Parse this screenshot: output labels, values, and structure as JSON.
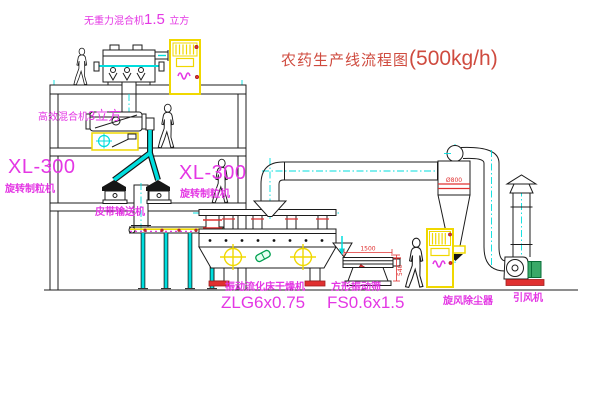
{
  "title": {
    "text": "农药生产线流程图",
    "capacity": "(500kg/h)"
  },
  "equipment_labels": {
    "gravity_mixer": {
      "name": "无重力混合机",
      "size": "1.5",
      "unit": "立方"
    },
    "high_mixer": {
      "name": "高效混合机",
      "size": "3立方"
    },
    "granulator_left": {
      "model": "XL-300",
      "name": "旋转制粒机"
    },
    "granulator_right": {
      "model": "XL-300",
      "name": "旋转制粒机"
    },
    "belt_conveyor": {
      "name": "皮带输送机"
    },
    "dryer": {
      "name": "振动流化床干燥机",
      "model": "ZLG6x0.75"
    },
    "sieve": {
      "name": "方形振动筛",
      "model": "FS0.6x1.5"
    },
    "cyclone": {
      "name": "旋风除尘器"
    },
    "fan": {
      "name": "引风机"
    }
  },
  "dimensions": {
    "sieve_length": "1500",
    "sieve_height": "540",
    "cyclone_diameter": "Ø800"
  },
  "colors": {
    "line": "#1c1c1c",
    "pipe_cyan": "#00dede",
    "label_magenta": "#e437e4",
    "title_red": "#cf4b3f",
    "dimension_red": "#e03030",
    "highlight_yellow": "#f0d800",
    "motor_green": "#3aa968"
  }
}
